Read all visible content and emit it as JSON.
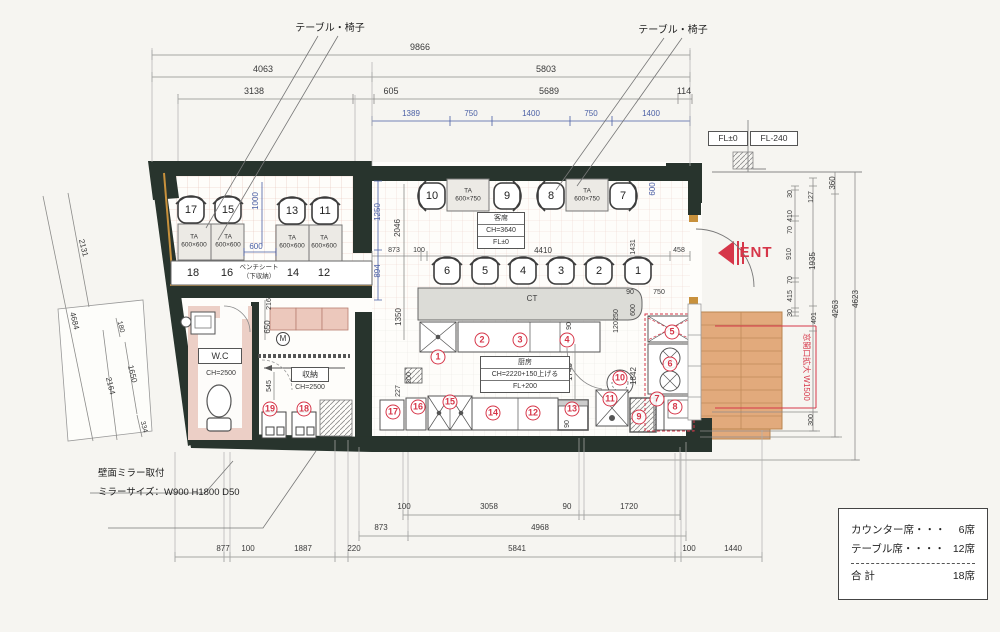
{
  "drawing": {
    "type": "restaurant-floor-plan",
    "accent_red": "#d63649",
    "dim_blue": "#4a5fa5",
    "wall_color": "#28342d"
  },
  "rooms": {
    "guest": [
      "客席",
      "CH=3640",
      "FL±0"
    ],
    "kitchen": [
      "厨房",
      "CH=2220+150上げる",
      "FL+200"
    ],
    "wc": "W.C",
    "storage": "収納",
    "fl_levels": [
      "FL±0",
      "FL-240"
    ]
  },
  "legend": {
    "rows": [
      {
        "label": "カウンター席・・・",
        "value": "6席"
      },
      {
        "label": "テーブル席・・・・",
        "value": "12席"
      }
    ],
    "total_label": "合 計",
    "total_value": "18席"
  },
  "labels": [
    {
      "t": "9866",
      "x": 420,
      "y": 47,
      "n": "dim-top-9866"
    },
    {
      "t": "4063",
      "x": 263,
      "y": 69,
      "n": "dim-top-4063"
    },
    {
      "t": "5803",
      "x": 546,
      "y": 69,
      "n": "dim-top-5803"
    },
    {
      "t": "3138",
      "x": 254,
      "y": 91,
      "n": "dim-top-3138"
    },
    {
      "t": "605",
      "x": 391,
      "y": 91,
      "n": "dim-top-605"
    },
    {
      "t": "5689",
      "x": 549,
      "y": 91,
      "n": "dim-top-5689"
    },
    {
      "t": "114",
      "x": 684,
      "y": 91,
      "n": "dim-top-114"
    },
    {
      "t": "1389",
      "x": 411,
      "y": 114,
      "c": "blue s8",
      "n": "dim-top-1389"
    },
    {
      "t": "750",
      "x": 471,
      "y": 114,
      "c": "blue s8",
      "n": "dim-top-750a"
    },
    {
      "t": "1400",
      "x": 531,
      "y": 114,
      "c": "blue s8",
      "n": "dim-top-1400a"
    },
    {
      "t": "750",
      "x": 591,
      "y": 114,
      "c": "blue s8",
      "n": "dim-top-750b"
    },
    {
      "t": "1400",
      "x": 651,
      "y": 114,
      "c": "blue s8",
      "n": "dim-top-1400b"
    },
    {
      "t": "テーブル・椅子",
      "x": 330,
      "y": 29,
      "c": "note",
      "n": "label-table-chairs-left"
    },
    {
      "t": "テーブル・椅子",
      "x": 673,
      "y": 31,
      "c": "note",
      "n": "label-table-chairs-right"
    },
    {
      "t": "360",
      "x": 833,
      "y": 183,
      "rot": -90,
      "c": "s8",
      "n": "dim-right-360"
    },
    {
      "t": "30",
      "x": 791,
      "y": 194,
      "rot": -90,
      "c": "s7",
      "n": "dim-right-30a"
    },
    {
      "t": "410",
      "x": 791,
      "y": 216,
      "rot": -90,
      "c": "s7",
      "n": "dim-right-410"
    },
    {
      "t": "70",
      "x": 791,
      "y": 230,
      "rot": -90,
      "c": "s7",
      "n": "dim-right-70a"
    },
    {
      "t": "910",
      "x": 790,
      "y": 254,
      "rot": -90,
      "c": "s7",
      "n": "dim-right-910"
    },
    {
      "t": "70",
      "x": 791,
      "y": 280,
      "rot": -90,
      "c": "s7",
      "n": "dim-right-70b"
    },
    {
      "t": "415",
      "x": 791,
      "y": 296,
      "rot": -90,
      "c": "s7",
      "n": "dim-right-415"
    },
    {
      "t": "30",
      "x": 791,
      "y": 313,
      "rot": -90,
      "c": "s7",
      "n": "dim-right-30b"
    },
    {
      "t": "127",
      "x": 812,
      "y": 197,
      "rot": -90,
      "c": "s7",
      "n": "dim-right-127"
    },
    {
      "t": "1935",
      "x": 813,
      "y": 261,
      "rot": -90,
      "c": "s8",
      "n": "dim-right-1935"
    },
    {
      "t": "401",
      "x": 815,
      "y": 318,
      "rot": -90,
      "c": "s7",
      "n": "dim-right-401"
    },
    {
      "t": "300",
      "x": 812,
      "y": 420,
      "rot": -90,
      "c": "s7",
      "n": "dim-right-300"
    },
    {
      "t": "4263",
      "x": 836,
      "y": 309,
      "rot": -90,
      "c": "s8",
      "n": "dim-right-4263"
    },
    {
      "t": "4623",
      "x": 856,
      "y": 299,
      "rot": -90,
      "c": "s8",
      "n": "dim-right-4623"
    },
    {
      "t": "ENT",
      "x": 756,
      "y": 253,
      "c": "ent",
      "n": "entrance-label"
    },
    {
      "t": "窓開口拡大 W1500",
      "x": 806,
      "y": 367,
      "rot": 90,
      "c": "rednote",
      "n": "label-logo-wall"
    },
    {
      "t": "2131",
      "x": 83,
      "y": 248,
      "rot": 76,
      "c": "s8",
      "n": "dim-left-2131"
    },
    {
      "t": "4684",
      "x": 74,
      "y": 321,
      "rot": 76,
      "c": "s8",
      "n": "dim-left-4684"
    },
    {
      "t": "180",
      "x": 120,
      "y": 327,
      "rot": 76,
      "c": "s7",
      "n": "dim-left-180"
    },
    {
      "t": "1650",
      "x": 132,
      "y": 374,
      "rot": 76,
      "c": "s8",
      "n": "dim-left-1650"
    },
    {
      "t": "2164",
      "x": 110,
      "y": 386,
      "rot": 76,
      "c": "s8",
      "n": "dim-left-2164"
    },
    {
      "t": "334",
      "x": 143,
      "y": 427,
      "rot": 76,
      "c": "s7",
      "n": "dim-left-334"
    },
    {
      "t": "17",
      "x": 191,
      "y": 210,
      "c": "seat",
      "n": "seat-17"
    },
    {
      "t": "15",
      "x": 228,
      "y": 210,
      "c": "seat",
      "n": "seat-15"
    },
    {
      "t": "13",
      "x": 292,
      "y": 211,
      "c": "seat",
      "n": "seat-13"
    },
    {
      "t": "11",
      "x": 325,
      "y": 211,
      "c": "seat",
      "n": "seat-11"
    },
    {
      "t": "18",
      "x": 193,
      "y": 273,
      "c": "seat",
      "n": "seat-18"
    },
    {
      "t": "16",
      "x": 227,
      "y": 273,
      "c": "seat",
      "n": "seat-16"
    },
    {
      "t": "14",
      "x": 293,
      "y": 273,
      "c": "seat",
      "n": "seat-14"
    },
    {
      "t": "12",
      "x": 324,
      "y": 273,
      "c": "seat",
      "n": "seat-12"
    },
    {
      "t": "ベンチシート",
      "x": 259,
      "y": 268,
      "c": "tiny",
      "n": "label-bench-seat"
    },
    {
      "t": "（下収納）",
      "x": 259,
      "y": 277,
      "c": "tiny",
      "n": "label-bench-storage"
    },
    {
      "t": "TA\n600×600",
      "x": 194,
      "y": 241,
      "c": "tbl",
      "n": "table-600x600-1"
    },
    {
      "t": "TA\n600×600",
      "x": 228,
      "y": 241,
      "c": "tbl",
      "n": "table-600x600-2"
    },
    {
      "t": "TA\n600×600",
      "x": 292,
      "y": 242,
      "c": "tbl",
      "n": "table-600x600-3"
    },
    {
      "t": "TA\n600×600",
      "x": 324,
      "y": 242,
      "c": "tbl",
      "n": "table-600x600-4"
    },
    {
      "t": "1000",
      "x": 256,
      "y": 201,
      "rot": -90,
      "c": "blue s8",
      "n": "dim-1000"
    },
    {
      "t": "600",
      "x": 256,
      "y": 247,
      "c": "blue s8",
      "n": "dim-600-aisle"
    },
    {
      "t": "1250",
      "x": 378,
      "y": 212,
      "rot": -90,
      "c": "blue s8",
      "n": "dim-1250"
    },
    {
      "t": "894",
      "x": 378,
      "y": 271,
      "rot": -90,
      "c": "blue s8",
      "n": "dim-894"
    },
    {
      "t": "2046",
      "x": 398,
      "y": 228,
      "rot": -90,
      "c": "s8",
      "n": "dim-2046"
    },
    {
      "t": "873",
      "x": 394,
      "y": 251,
      "c": "s7",
      "n": "dim-873a"
    },
    {
      "t": "100",
      "x": 419,
      "y": 251,
      "c": "s7",
      "n": "dim-100a"
    },
    {
      "t": "TA\n600×750",
      "x": 468,
      "y": 195,
      "c": "tbl",
      "n": "table-600x750-1"
    },
    {
      "t": "TA\n600×750",
      "x": 587,
      "y": 195,
      "c": "tbl",
      "n": "table-600x750-2"
    },
    {
      "t": "10",
      "x": 432,
      "y": 196,
      "c": "seat",
      "n": "seat-10-label"
    },
    {
      "t": "9",
      "x": 507,
      "y": 196,
      "c": "seat",
      "n": "seat-9-label"
    },
    {
      "t": "8",
      "x": 551,
      "y": 196,
      "c": "seat",
      "n": "seat-8-label"
    },
    {
      "t": "7",
      "x": 623,
      "y": 196,
      "c": "seat",
      "n": "seat-7-label"
    },
    {
      "t": "600",
      "x": 653,
      "y": 189,
      "rot": -90,
      "c": "blue s8",
      "n": "dim-600-niche"
    },
    {
      "t": "4410",
      "x": 543,
      "y": 251,
      "c": "s8",
      "n": "dim-4410"
    },
    {
      "t": "1431",
      "x": 634,
      "y": 247,
      "rot": -90,
      "c": "s7",
      "n": "dim-1431"
    },
    {
      "t": "458",
      "x": 679,
      "y": 251,
      "c": "s7",
      "n": "dim-458"
    },
    {
      "t": "CT",
      "x": 532,
      "y": 299,
      "c": "s8",
      "n": "counter-label"
    },
    {
      "t": "90",
      "x": 630,
      "y": 293,
      "c": "s7",
      "n": "dim-90a"
    },
    {
      "t": "750",
      "x": 659,
      "y": 293,
      "c": "s7",
      "n": "dim-750c"
    },
    {
      "t": "600",
      "x": 634,
      "y": 310,
      "rot": -90,
      "c": "s7",
      "n": "dim-600c"
    },
    {
      "t": "250",
      "x": 617,
      "y": 315,
      "rot": -90,
      "c": "s7",
      "n": "dim-250"
    },
    {
      "t": "120",
      "x": 617,
      "y": 327,
      "rot": -90,
      "c": "s7",
      "n": "dim-120"
    },
    {
      "t": "6",
      "x": 447,
      "y": 271,
      "c": "seat",
      "n": "seat-6-label"
    },
    {
      "t": "5",
      "x": 485,
      "y": 271,
      "c": "seat",
      "n": "seat-5-label"
    },
    {
      "t": "4",
      "x": 523,
      "y": 271,
      "c": "seat",
      "n": "seat-4-label"
    },
    {
      "t": "3",
      "x": 561,
      "y": 271,
      "c": "seat",
      "n": "seat-3-label"
    },
    {
      "t": "2",
      "x": 599,
      "y": 271,
      "c": "seat",
      "n": "seat-2-label"
    },
    {
      "t": "1",
      "x": 638,
      "y": 271,
      "c": "seat",
      "n": "seat-1-label"
    },
    {
      "t": "1350",
      "x": 399,
      "y": 317,
      "rot": -90,
      "c": "s8",
      "n": "dim-1350"
    },
    {
      "t": "200",
      "x": 410,
      "y": 378,
      "rot": -90,
      "c": "s7",
      "n": "dim-200"
    },
    {
      "t": "227",
      "x": 399,
      "y": 391,
      "rot": -90,
      "c": "s7",
      "n": "dim-227"
    },
    {
      "t": "90",
      "x": 570,
      "y": 326,
      "rot": -90,
      "c": "s7",
      "n": "dim-90b"
    },
    {
      "t": "1740",
      "x": 570,
      "y": 372,
      "rot": -90,
      "c": "s8",
      "n": "dim-1740"
    },
    {
      "t": "90",
      "x": 568,
      "y": 424,
      "rot": -90,
      "c": "s7",
      "n": "dim-90c"
    },
    {
      "t": "1842",
      "x": 634,
      "y": 376,
      "rot": -90,
      "c": "s8",
      "n": "dim-1842"
    },
    {
      "t": "545",
      "x": 270,
      "y": 386,
      "rot": -90,
      "c": "s7",
      "n": "dim-545"
    },
    {
      "t": "216",
      "x": 270,
      "y": 304,
      "rot": -90,
      "c": "s7",
      "n": "dim-216"
    },
    {
      "t": "650",
      "x": 268,
      "y": 327,
      "rot": -90,
      "c": "s8",
      "n": "dim-650"
    },
    {
      "t": "CH=2500",
      "x": 221,
      "y": 374,
      "c": "s7",
      "n": "wc-ceiling-height"
    },
    {
      "t": "CH=2500",
      "x": 310,
      "y": 388,
      "c": "s7",
      "n": "storage-ceiling-height"
    },
    {
      "t": "100",
      "x": 404,
      "y": 507,
      "c": "s8",
      "n": "dim-bottom-100a"
    },
    {
      "t": "3058",
      "x": 489,
      "y": 507,
      "c": "s8",
      "n": "dim-bottom-3058"
    },
    {
      "t": "90",
      "x": 567,
      "y": 507,
      "c": "s8",
      "n": "dim-bottom-90"
    },
    {
      "t": "1720",
      "x": 629,
      "y": 507,
      "c": "s8",
      "n": "dim-bottom-1720"
    },
    {
      "t": "873",
      "x": 381,
      "y": 528,
      "c": "s8",
      "n": "dim-bottom-873"
    },
    {
      "t": "4968",
      "x": 540,
      "y": 528,
      "c": "s8",
      "n": "dim-bottom-4968"
    },
    {
      "t": "877",
      "x": 223,
      "y": 549,
      "c": "s8",
      "n": "dim-bottom-877"
    },
    {
      "t": "100",
      "x": 248,
      "y": 549,
      "c": "s8",
      "n": "dim-bottom-100b"
    },
    {
      "t": "1887",
      "x": 303,
      "y": 549,
      "c": "s8",
      "n": "dim-bottom-1887"
    },
    {
      "t": "220",
      "x": 354,
      "y": 549,
      "c": "s8",
      "n": "dim-bottom-220"
    },
    {
      "t": "5841",
      "x": 517,
      "y": 549,
      "c": "s8",
      "n": "dim-bottom-5841"
    },
    {
      "t": "100",
      "x": 689,
      "y": 549,
      "c": "s8",
      "n": "dim-bottom-100c"
    },
    {
      "t": "1440",
      "x": 733,
      "y": 549,
      "c": "s8",
      "n": "dim-bottom-1440"
    },
    {
      "t": "壁面ミラー取付",
      "x": 98,
      "y": 474,
      "c": "noteL",
      "n": "note-wall-mirror"
    },
    {
      "t": "ミラーサイズ：W900 H1800 D50",
      "x": 98,
      "y": 493,
      "c": "noteL",
      "n": "note-mirror-size"
    },
    {
      "t": "1",
      "x": 438,
      "y": 357,
      "c": "circ",
      "n": "equip-1"
    },
    {
      "t": "2",
      "x": 482,
      "y": 340,
      "c": "circ",
      "n": "equip-2"
    },
    {
      "t": "3",
      "x": 520,
      "y": 340,
      "c": "circ",
      "n": "equip-3"
    },
    {
      "t": "4",
      "x": 567,
      "y": 340,
      "c": "circ",
      "n": "equip-4"
    },
    {
      "t": "5",
      "x": 672,
      "y": 332,
      "c": "circ",
      "n": "equip-5"
    },
    {
      "t": "6",
      "x": 670,
      "y": 364,
      "c": "circ",
      "n": "equip-6"
    },
    {
      "t": "7",
      "x": 657,
      "y": 399,
      "c": "circ",
      "n": "equip-7"
    },
    {
      "t": "8",
      "x": 675,
      "y": 407,
      "c": "circ",
      "n": "equip-8"
    },
    {
      "t": "9",
      "x": 639,
      "y": 417,
      "c": "circ",
      "n": "equip-9"
    },
    {
      "t": "10",
      "x": 620,
      "y": 378,
      "c": "circ",
      "n": "equip-10"
    },
    {
      "t": "11",
      "x": 610,
      "y": 399,
      "c": "circ",
      "n": "equip-11"
    },
    {
      "t": "12",
      "x": 533,
      "y": 413,
      "c": "circ",
      "n": "equip-12"
    },
    {
      "t": "13",
      "x": 572,
      "y": 409,
      "c": "circ",
      "n": "equip-13"
    },
    {
      "t": "14",
      "x": 493,
      "y": 413,
      "c": "circ",
      "n": "equip-14"
    },
    {
      "t": "15",
      "x": 450,
      "y": 402,
      "c": "circ",
      "n": "equip-15"
    },
    {
      "t": "16",
      "x": 418,
      "y": 407,
      "c": "circ",
      "n": "equip-16"
    },
    {
      "t": "17",
      "x": 393,
      "y": 412,
      "c": "circ",
      "n": "equip-17"
    },
    {
      "t": "18",
      "x": 304,
      "y": 409,
      "c": "circ",
      "n": "equip-18"
    },
    {
      "t": "19",
      "x": 270,
      "y": 409,
      "c": "circ",
      "n": "equip-19"
    },
    {
      "t": "M",
      "x": 283,
      "y": 339,
      "c": "meter",
      "n": "gas-meter"
    }
  ]
}
